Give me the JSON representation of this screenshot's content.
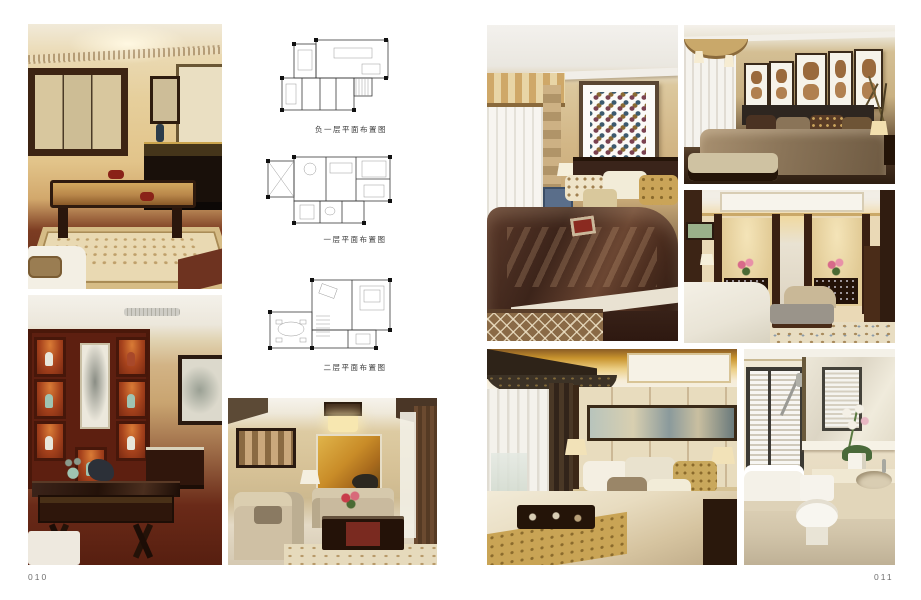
{
  "pages": {
    "left_number": "010",
    "right_number": "011"
  },
  "floor_plans": [
    {
      "name": "basement-floor-plan",
      "caption": "负一层平面布置图"
    },
    {
      "name": "first-floor-plan",
      "caption": "一层平面布置图"
    },
    {
      "name": "second-floor-plan",
      "caption": "二层平面布置图"
    }
  ],
  "photos": [
    "living-room-with-carved-coffee-table",
    "study-with-red-display-shelving",
    "living-room-with-gold-landscape-painting",
    "bedroom-with-dot-grid-artwork",
    "bedroom-with-five-framed-artworks",
    "bedroom-with-mirrored-panels-and-consoles",
    "master-bedroom-with-long-scroll-artwork",
    "bathroom-with-orchid-and-vanity"
  ],
  "colors": {
    "paper": "#ffffff",
    "warm_wall": "#d2b686",
    "dark_wood": "#3a241a",
    "red_lacquer_shelf": "#5d1f10",
    "brown_bedspread": "#3c241a",
    "gold_accent": "#c9a455",
    "plan_line": "#3a3a3a",
    "caption_text": "#3c3c3c"
  }
}
